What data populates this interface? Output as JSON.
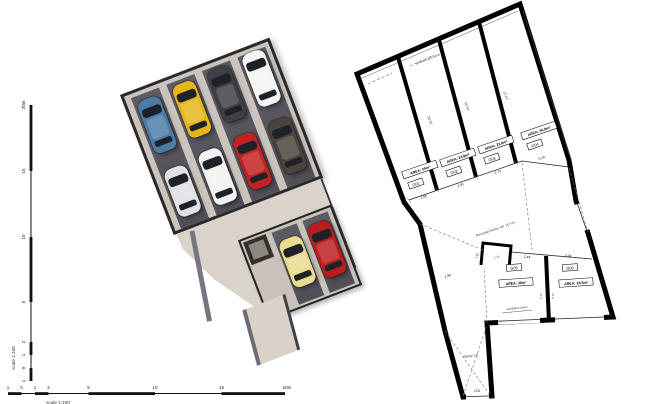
{
  "view3d": {
    "cars": [
      {
        "name": "car-blue",
        "color": "#4d7ba7"
      },
      {
        "name": "car-silver",
        "color": "#dfe1e3"
      },
      {
        "name": "car-yellow",
        "color": "#e4b61a"
      },
      {
        "name": "car-white",
        "color": "#f2f2f0"
      },
      {
        "name": "car-darkgrey",
        "color": "#3f4045"
      },
      {
        "name": "car-red",
        "color": "#c32222"
      },
      {
        "name": "car-white-2",
        "color": "#f4f4f2"
      },
      {
        "name": "car-brown",
        "color": "#4a443b"
      },
      {
        "name": "car-cream",
        "color": "#e9dc8f"
      },
      {
        "name": "car-red-2",
        "color": "#bb1d1d"
      }
    ],
    "palette": {
      "floor": "#d9d3ca",
      "wall": "#cac4bc",
      "asphalt": "#56545c",
      "outline": "#2a2a2a"
    }
  },
  "floorplan": {
    "garages": [
      {
        "id": "G01",
        "area": "AREA: 24m²",
        "width": "2.85",
        "length": ""
      },
      {
        "id": "G02",
        "area": "AREA: 24.8m²",
        "width": "2.81",
        "length": "10.30"
      },
      {
        "id": "G03",
        "area": "AREA: 22.6m²",
        "width": "2.73",
        "length": "10.02"
      },
      {
        "id": "G04",
        "area": "AREA: 46.9m²",
        "width": "5.24",
        "length": "17.17"
      },
      {
        "id": "G05",
        "area": "AREA: 26m²",
        "width": "2.44",
        "length": "5.73"
      },
      {
        "id": "G06",
        "area": "AREA: 24.5m²",
        "width": "3.34",
        "length": "5.77"
      }
    ],
    "annotations": {
      "reversal_sector": "Reversal Sector ref: 117 m²",
      "ventilation_grill": "ventilation grill plans",
      "ventilation_doors": "ventilation doors",
      "ramp": "Ramp 1:5",
      "ramp_bottom_width": "2.52",
      "corridor_width": "2.98",
      "vestibule_width": "1.92",
      "vestibule_depth": "1.73"
    }
  },
  "scalebar": {
    "vertical_ticks": [
      "20m",
      "15",
      "10",
      "5",
      "2",
      "1",
      "0",
      "1"
    ],
    "horizontal_ticks": [
      "1",
      "0",
      "1",
      "2",
      "5",
      "10",
      "15",
      "20m"
    ],
    "ratio_vertical": "scale 1:100",
    "ratio_horizontal": "scale 1:100"
  }
}
